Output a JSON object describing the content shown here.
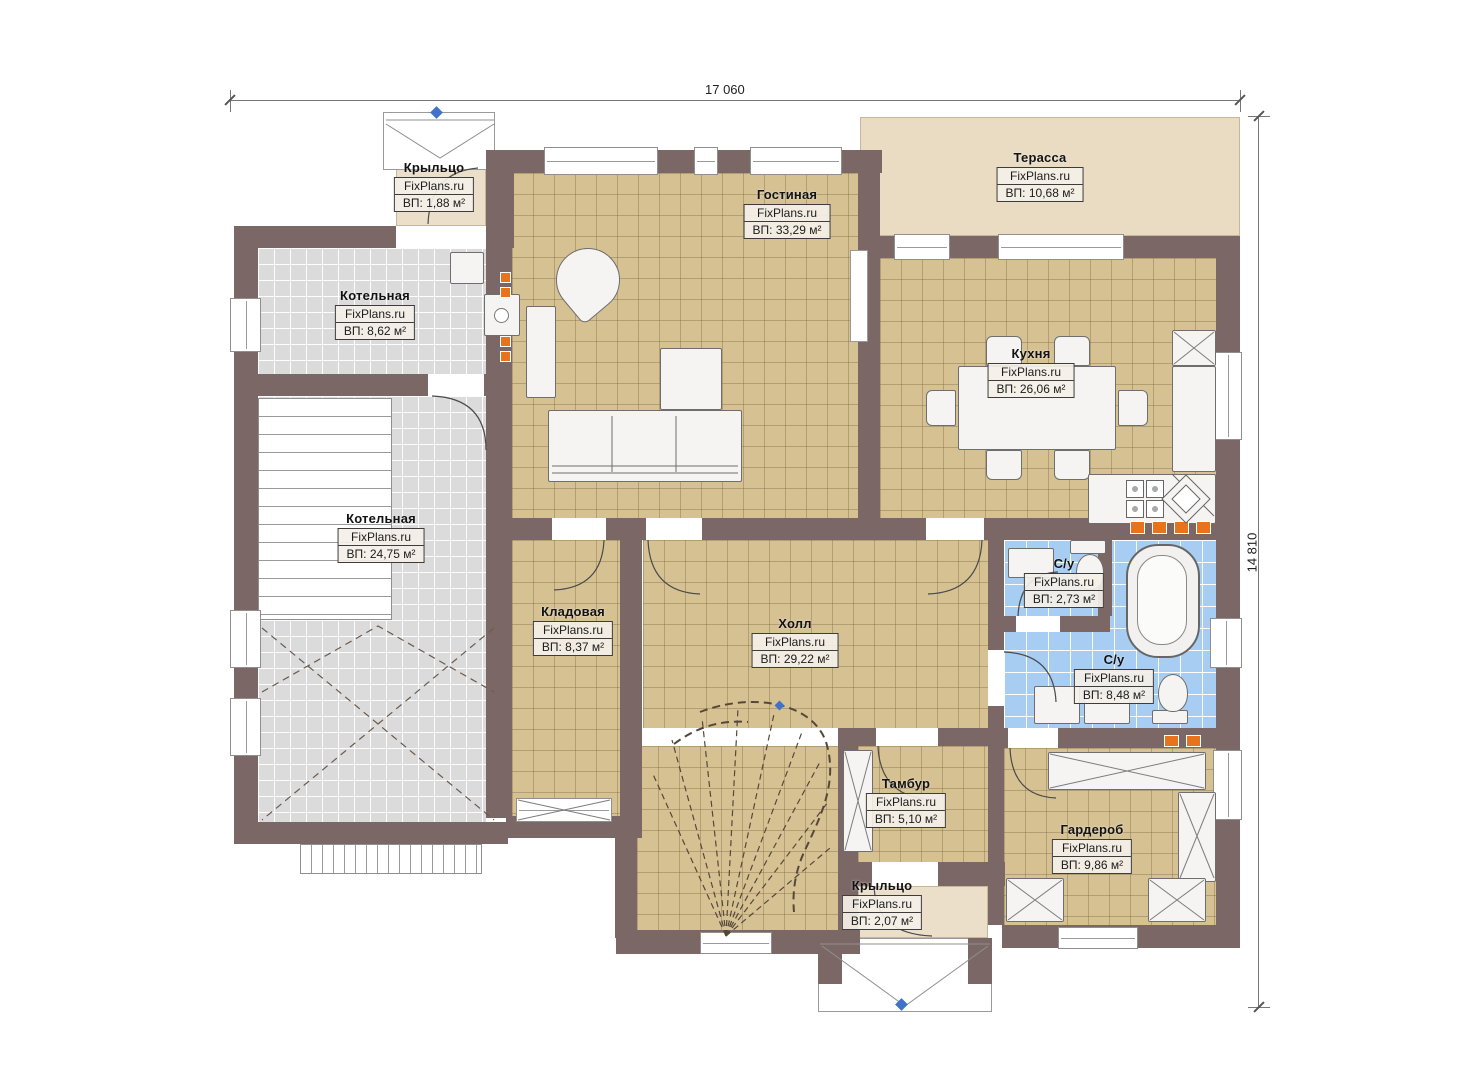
{
  "dims": {
    "top": "17 060",
    "right": "14 810"
  },
  "rooms": [
    {
      "id": "porch-top",
      "name": "Крыльцо",
      "watermark": "FixPlans.ru",
      "area": "ВП: 1,88 м²"
    },
    {
      "id": "boiler-small",
      "name": "Котельная",
      "watermark": "FixPlans.ru",
      "area": "ВП: 8,62 м²"
    },
    {
      "id": "living",
      "name": "Гостиная",
      "watermark": "FixPlans.ru",
      "area": "ВП: 33,29 м²"
    },
    {
      "id": "terrace",
      "name": "Терасса",
      "watermark": "FixPlans.ru",
      "area": "ВП: 10,68 м²"
    },
    {
      "id": "kitchen",
      "name": "Кухня",
      "watermark": "FixPlans.ru",
      "area": "ВП: 26,06 м²"
    },
    {
      "id": "boiler-big",
      "name": "Котельная",
      "watermark": "FixPlans.ru",
      "area": "ВП: 24,75 м²"
    },
    {
      "id": "storage",
      "name": "Кладовая",
      "watermark": "FixPlans.ru",
      "area": "ВП: 8,37 м²"
    },
    {
      "id": "hall",
      "name": "Холл",
      "watermark": "FixPlans.ru",
      "area": "ВП: 29,22 м²"
    },
    {
      "id": "wc-small",
      "name": "С/у",
      "watermark": "FixPlans.ru",
      "area": "ВП: 2,73 м²"
    },
    {
      "id": "wc-big",
      "name": "С/у",
      "watermark": "FixPlans.ru",
      "area": "ВП: 8,48 м²"
    },
    {
      "id": "tambour",
      "name": "Тамбур",
      "watermark": "FixPlans.ru",
      "area": "ВП: 5,10 м²"
    },
    {
      "id": "wardrobe",
      "name": "Гардероб",
      "watermark": "FixPlans.ru",
      "area": "ВП: 9,86 м²"
    },
    {
      "id": "porch-bottom",
      "name": "Крыльцо",
      "watermark": "FixPlans.ru",
      "area": "ВП: 2,07 м²"
    }
  ],
  "colors": {
    "wall": "#7b6866",
    "floor_beige": "#d6c193",
    "floor_gray": "#dbdbdb",
    "floor_blue": "#a7cdf2",
    "terrace": "#e9dcc3",
    "accent_orange": "#e8731d",
    "marker_blue": "#3f72c8"
  }
}
